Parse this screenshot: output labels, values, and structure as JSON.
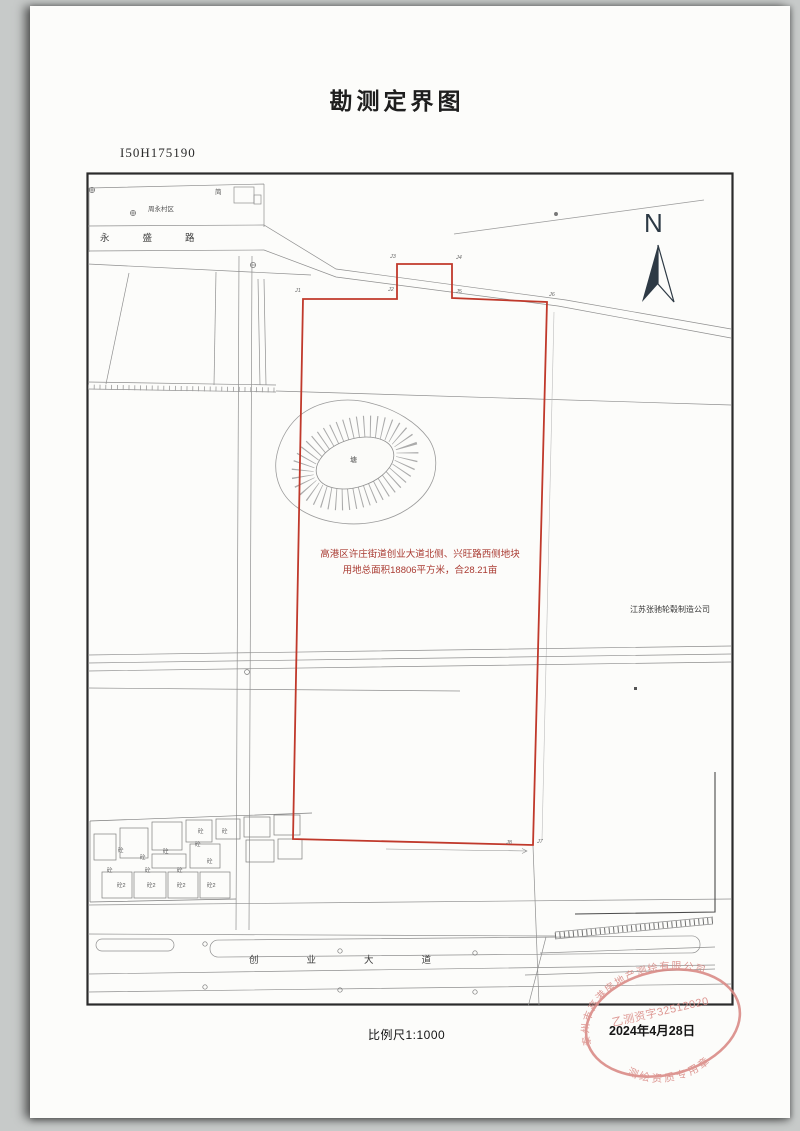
{
  "header": {
    "title": "勘测定界图",
    "doc_number": "I50H175190"
  },
  "map": {
    "north": "N",
    "road_top": "永盛路",
    "road_bottom": "创业大道",
    "village": "周永村区",
    "bldg_note": "简",
    "pond": "塘",
    "mat_label": "砼",
    "mat_label2": "砼2",
    "plot_line1": "高港区许庄街道创业大道北侧、兴旺路西侧地块",
    "plot_line2": "用地总面积18806平方米，合28.21亩",
    "company": "江苏张驰轮毂制造公司",
    "points": {
      "j1": "J1",
      "j2": "J2",
      "j3": "J3",
      "j4": "J4",
      "j5": "J5",
      "j6": "J6",
      "j7": "J7",
      "j8": "J8"
    }
  },
  "footer": {
    "scale": "比例尺1:1000",
    "date": "2024年4月28日"
  },
  "stamp": {
    "company_arc": "泰州市高港房地产测绘有限公司",
    "license": "乙测资字32512020",
    "type": "测绘资质专用章"
  },
  "colors": {
    "boundary_red": "#c0392b",
    "annotation_red": "#a93a31",
    "stamp_red": "#d98984",
    "line_gray": "#8f8f8f"
  }
}
